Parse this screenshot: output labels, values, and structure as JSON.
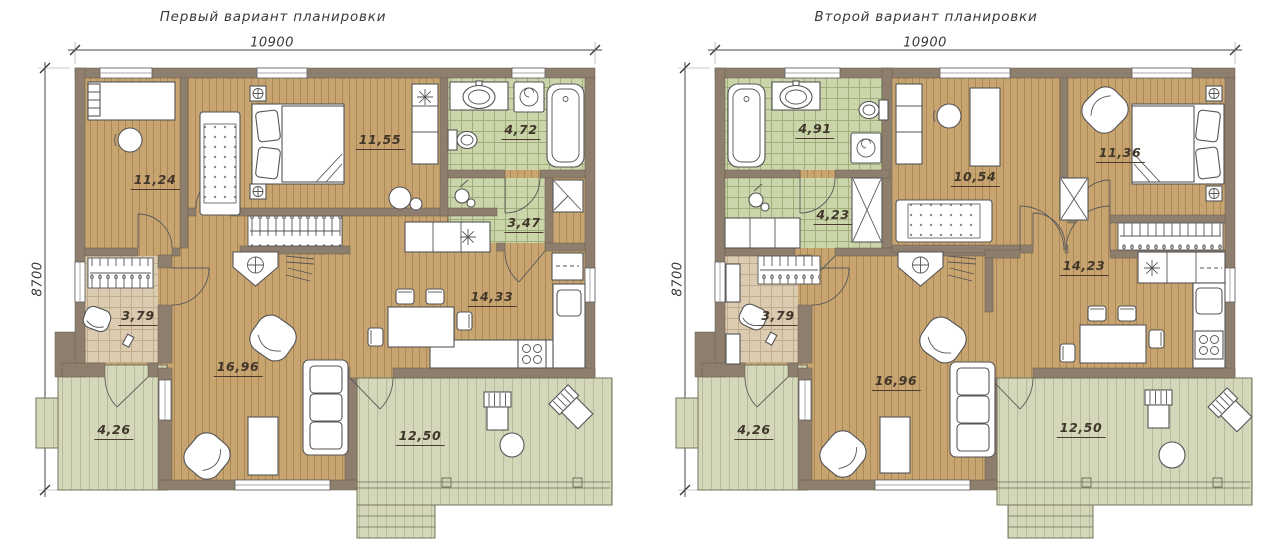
{
  "plans": [
    {
      "title": "Первый вариант планировки",
      "width_mm": "10900",
      "height_mm": "8700",
      "rooms": [
        {
          "id": "study",
          "area": "11,24"
        },
        {
          "id": "bedroom",
          "area": "11,55"
        },
        {
          "id": "bathroom",
          "area": "4,72"
        },
        {
          "id": "hall",
          "area": "3,47"
        },
        {
          "id": "entry",
          "area": "3,79"
        },
        {
          "id": "living-room",
          "area": "16,96"
        },
        {
          "id": "kitchen-dining",
          "area": "14,33"
        },
        {
          "id": "porch",
          "area": "4,26"
        },
        {
          "id": "terrace",
          "area": "12,50"
        }
      ]
    },
    {
      "title": "Второй вариант планировки",
      "width_mm": "10900",
      "height_mm": "8700",
      "rooms": [
        {
          "id": "bathroom",
          "area": "4,91"
        },
        {
          "id": "hall",
          "area": "4,23"
        },
        {
          "id": "study",
          "area": "10,54"
        },
        {
          "id": "bedroom",
          "area": "11,36"
        },
        {
          "id": "kitchen-dining",
          "area": "14,23"
        },
        {
          "id": "entry",
          "area": "3,79"
        },
        {
          "id": "living-room",
          "area": "16,96"
        },
        {
          "id": "porch",
          "area": "4,26"
        },
        {
          "id": "terrace",
          "area": "12,50"
        }
      ]
    }
  ],
  "colors": {
    "wall": "#8d7e6d",
    "wood_floor": "#c7a470",
    "wood_floor_line": "#ab8855",
    "tile_green": "#cbd5aa",
    "tile_green_line": "#9fae7c",
    "tile_beige": "#dbcbb0",
    "tile_beige_line": "#c1ad8e",
    "deck": "#d4d7ba",
    "deck_line": "#b8bc9c",
    "furniture_line": "#555555",
    "label_text": "#41362a",
    "dimension_text": "#3a3a3a"
  }
}
